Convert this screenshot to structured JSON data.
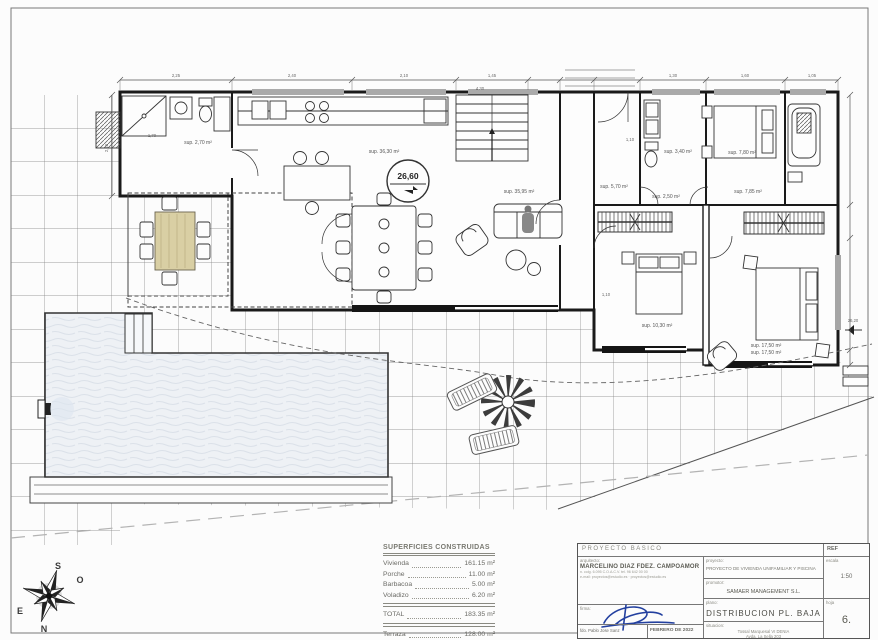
{
  "drawing": {
    "level_markers": {
      "main": "26,60",
      "right": "26,20"
    },
    "room_labels": {
      "aseo": "sup. 2,70 m²",
      "cocina": "sup. 36,30 m²",
      "salon": "sup. 35,95 m²",
      "hall": "sup. 5,70 m²",
      "bano1": "sup. 3,40 m²",
      "distribuidor": "sup. 2,50 m²",
      "dormitorio3": "sup. 7,80 m²",
      "vestidor": "sup. 7,85 m²",
      "dormitorio1": "sup. 10,30 m²",
      "dormitorio2a": "sup. 17,50 m²",
      "dormitorio2b": "sup. 17,50 m²"
    },
    "dims": {
      "top": [
        "2,25",
        "2,40",
        "2,10",
        "1,45",
        "1,30",
        "1,60",
        "1,05"
      ],
      "d170": "1,70",
      "d430": "4,30",
      "d110a": "1,10",
      "d110b": "1,10",
      "left": "2,10"
    },
    "compass": {
      "n": "N",
      "s": "S",
      "e": "E",
      "o": "O"
    }
  },
  "areas_table": {
    "title": "SUPERFICIES CONSTRUIDAS",
    "rows": [
      {
        "name": "Vivienda",
        "value": "161.15 m²"
      },
      {
        "name": "Porche",
        "value": "11.00 m²"
      },
      {
        "name": "Barbacoa",
        "value": "5.00 m²"
      },
      {
        "name": "Voladizo",
        "value": "6.20 m²"
      }
    ],
    "total": {
      "name": "TOTAL",
      "value": "183.35 m²"
    },
    "extra": [
      {
        "name": "Terraza",
        "value": "128.00 m²"
      },
      {
        "name": "Piscina",
        "value": "60.00 m²"
      }
    ]
  },
  "title_block": {
    "header": "PROYECTO   BASICO",
    "ref_label": "REF",
    "arquitecto_label": "arquitecto:",
    "arquitecto": "MARCELINO DIAZ FDEZ. CAMPOAMOR",
    "contact1": "n. colg. 6.095 C.O.A.C.V.   tel. 96 642 00 00",
    "contact2": "e-mail: proyectos@estudio.es  ·  proyectos@estudio.es",
    "firma_label": "firma:",
    "fdo": "fdo. Pablo Jose Sanz",
    "fecha": "FEBRERO DE 2022",
    "proyecto_label": "proyecto:",
    "proyecto": "PROYECTO DE VIVIENDA UNIFAMILIAR Y PISCINA",
    "promotor_label": "promotor:",
    "promotor": "SAMAER MANAGEMENT S.L.",
    "plano_label": "plano:",
    "plano": "DISTRIBUCION  PL.  BAJA",
    "situacion_label": "situacion:",
    "situacion1": "Tossal Marquesal VI  DENIA",
    "situacion2": "Avda. La Sella 203",
    "escala_label": "escala",
    "escala": "1:50",
    "hoja_label": "hoja",
    "hoja": "6."
  }
}
